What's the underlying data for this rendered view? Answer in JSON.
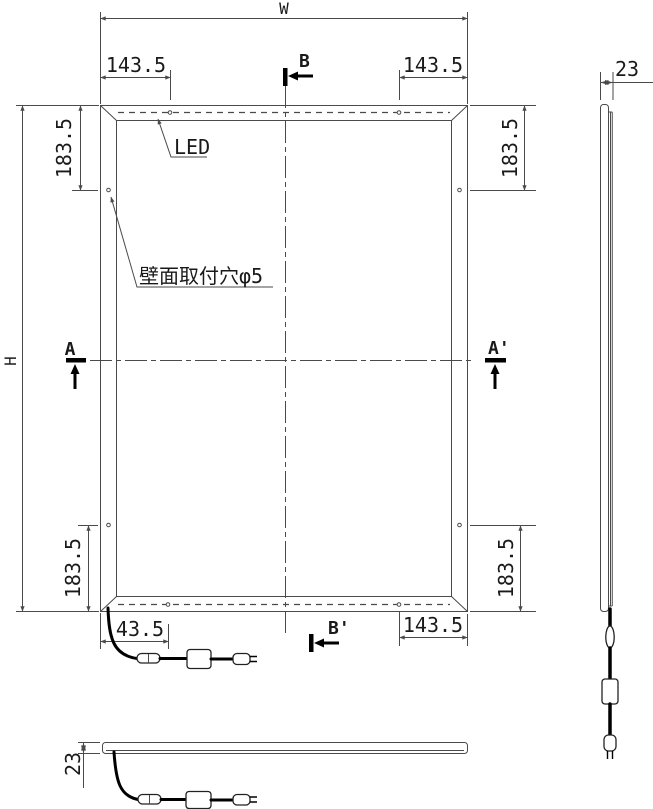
{
  "drawing_type": "technical-drawing",
  "front_view": {
    "width_label": "W",
    "height_label": "H",
    "top_left_hole_offset": "143.5",
    "top_right_hole_offset": "143.5",
    "left_top_hole_offset": "183.5",
    "right_top_hole_offset": "183.5",
    "left_bottom_hole_offset": "183.5",
    "right_bottom_hole_offset": "183.5",
    "bottom_right_hole_offset": "143.5",
    "cable_exit_offset": "43.5",
    "led_label": "LED",
    "mount_hole_label": "壁面取付穴φ5",
    "section_b_top": "B",
    "section_b_bottom": "B'",
    "section_a_left": "A",
    "section_a_right": "A'"
  },
  "side_view": {
    "thickness": "23"
  },
  "bottom_view": {
    "thickness": "23"
  }
}
